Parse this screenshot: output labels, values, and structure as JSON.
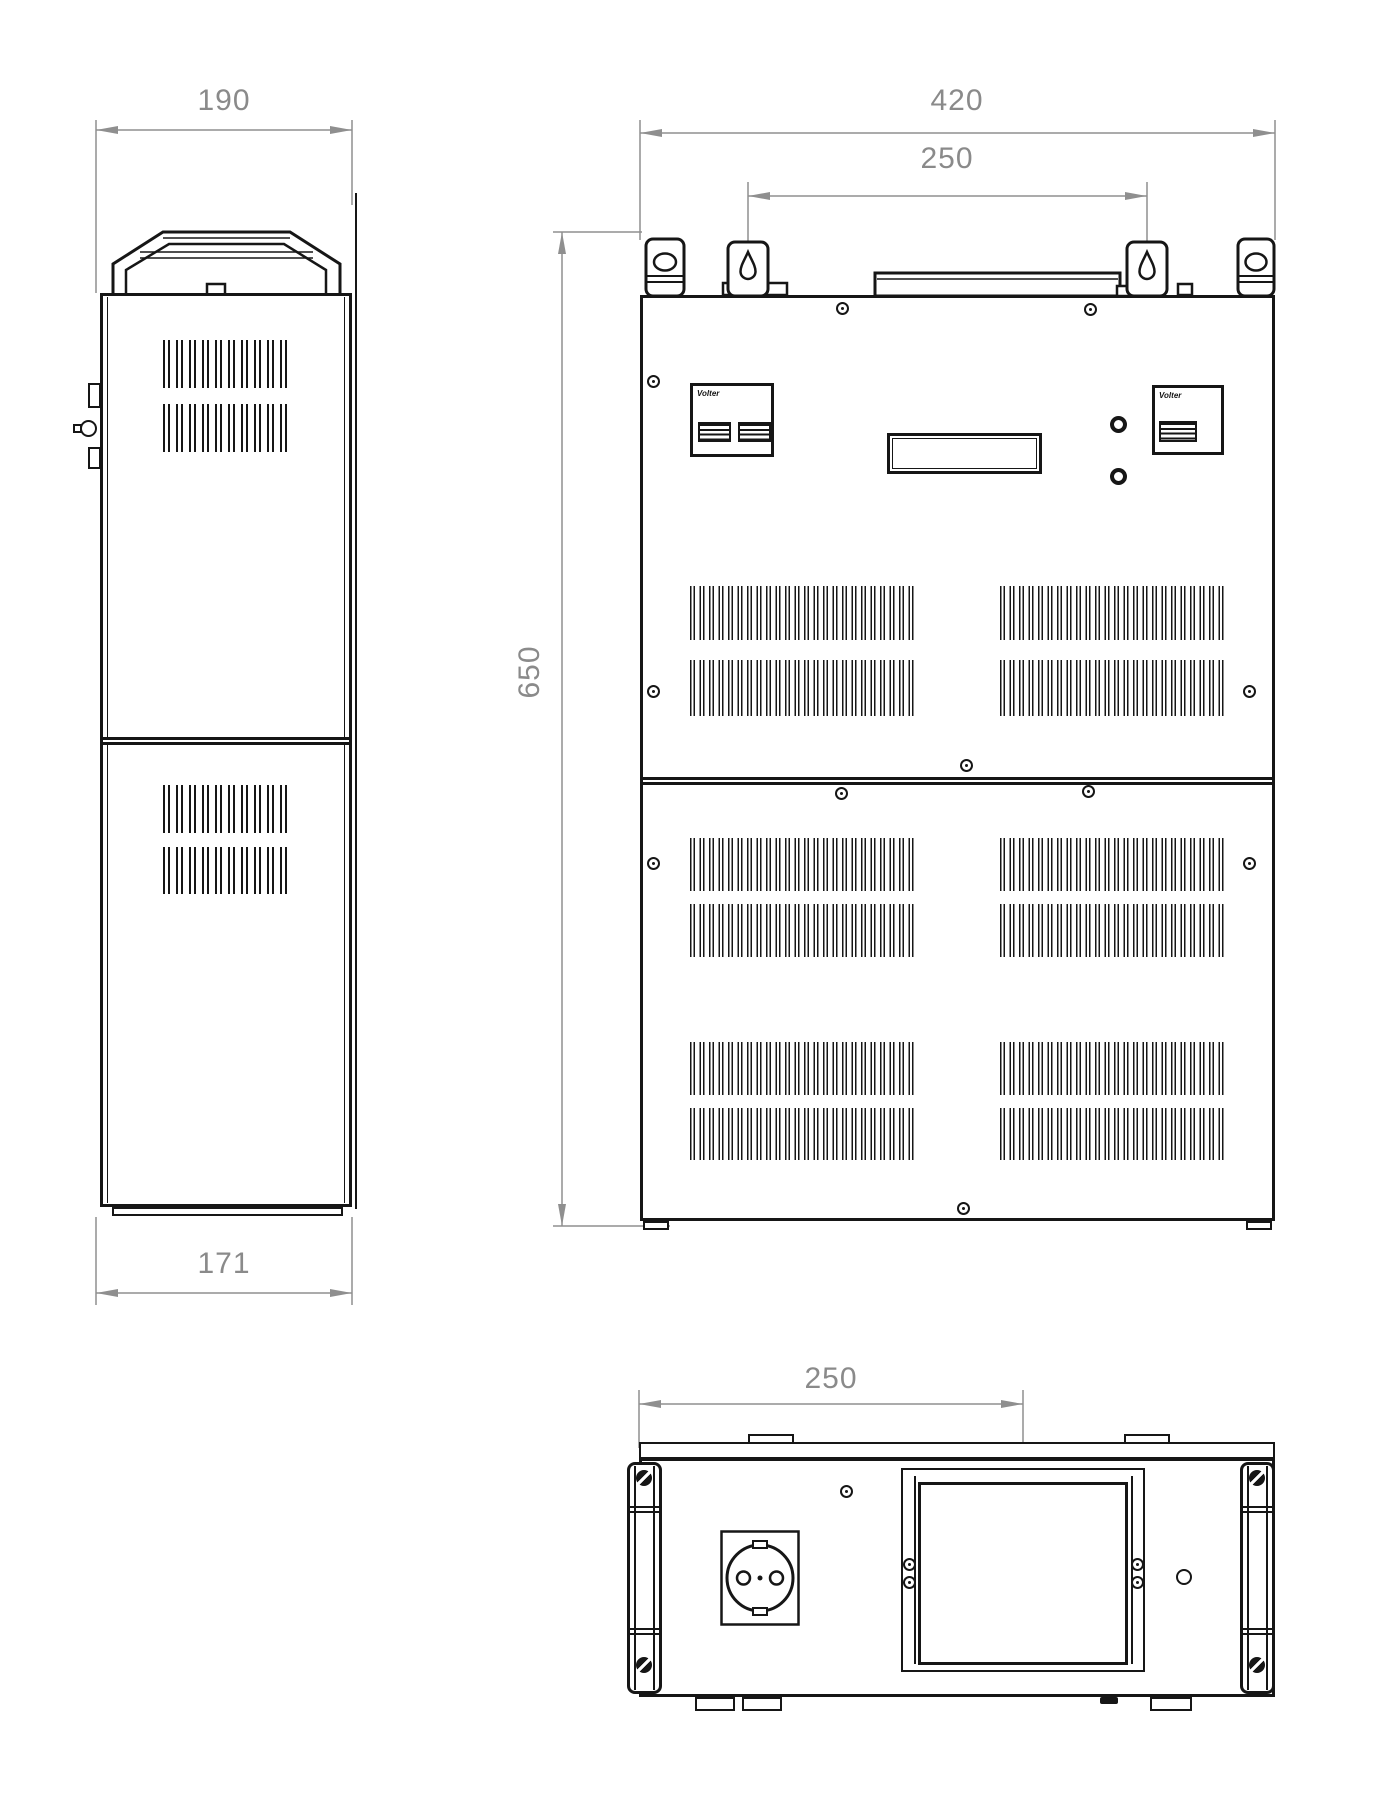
{
  "drawing": {
    "brand": "Volter",
    "colors": {
      "line": "#161616",
      "dimension": "#8a8a8a",
      "background": "#ffffff"
    },
    "dims": {
      "side_top_width": "190",
      "side_bottom_width": "171",
      "front_width": "420",
      "front_bracket_span": "250",
      "front_height": "650",
      "bottom_offset": "250"
    },
    "icons": {
      "keyhole-mount-icon": "teardrop keyhole hanger",
      "power-socket-icon": "round power socket with two pin holes",
      "vent-grille": "vertical ventilation slots",
      "screw-hole": "panel screw"
    }
  }
}
